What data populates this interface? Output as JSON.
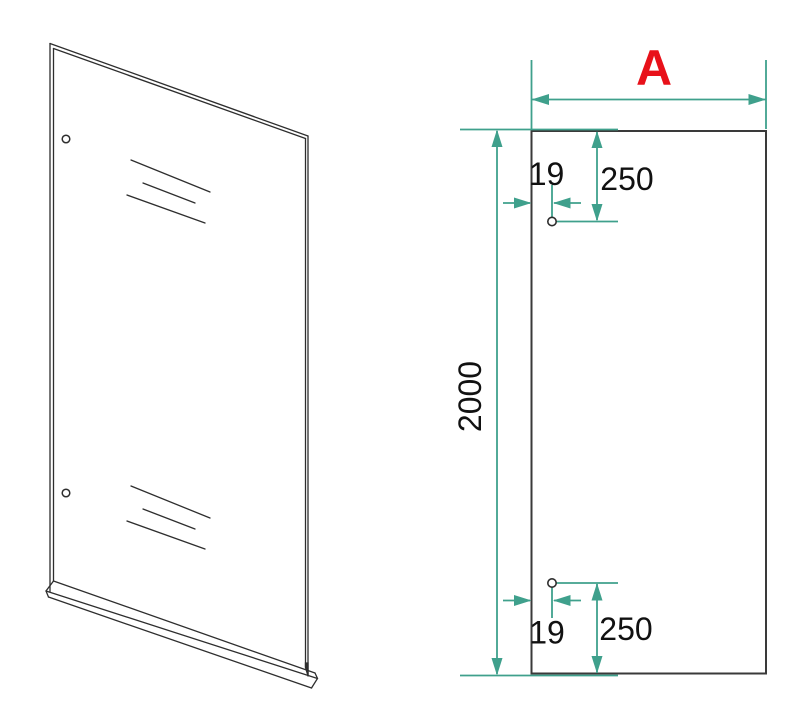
{
  "drawing": {
    "background": "#ffffff",
    "colors": {
      "dimension": "#3fa08c",
      "accent": "#e8111a",
      "outline": "#3a3a3a",
      "sketch": "#2e2e2e"
    },
    "labels": {
      "width": "A",
      "height": "2000",
      "top_hole_offset": "19",
      "top_hole_distance": "250",
      "bottom_hole_offset": "19",
      "bottom_hole_distance": "250"
    }
  }
}
